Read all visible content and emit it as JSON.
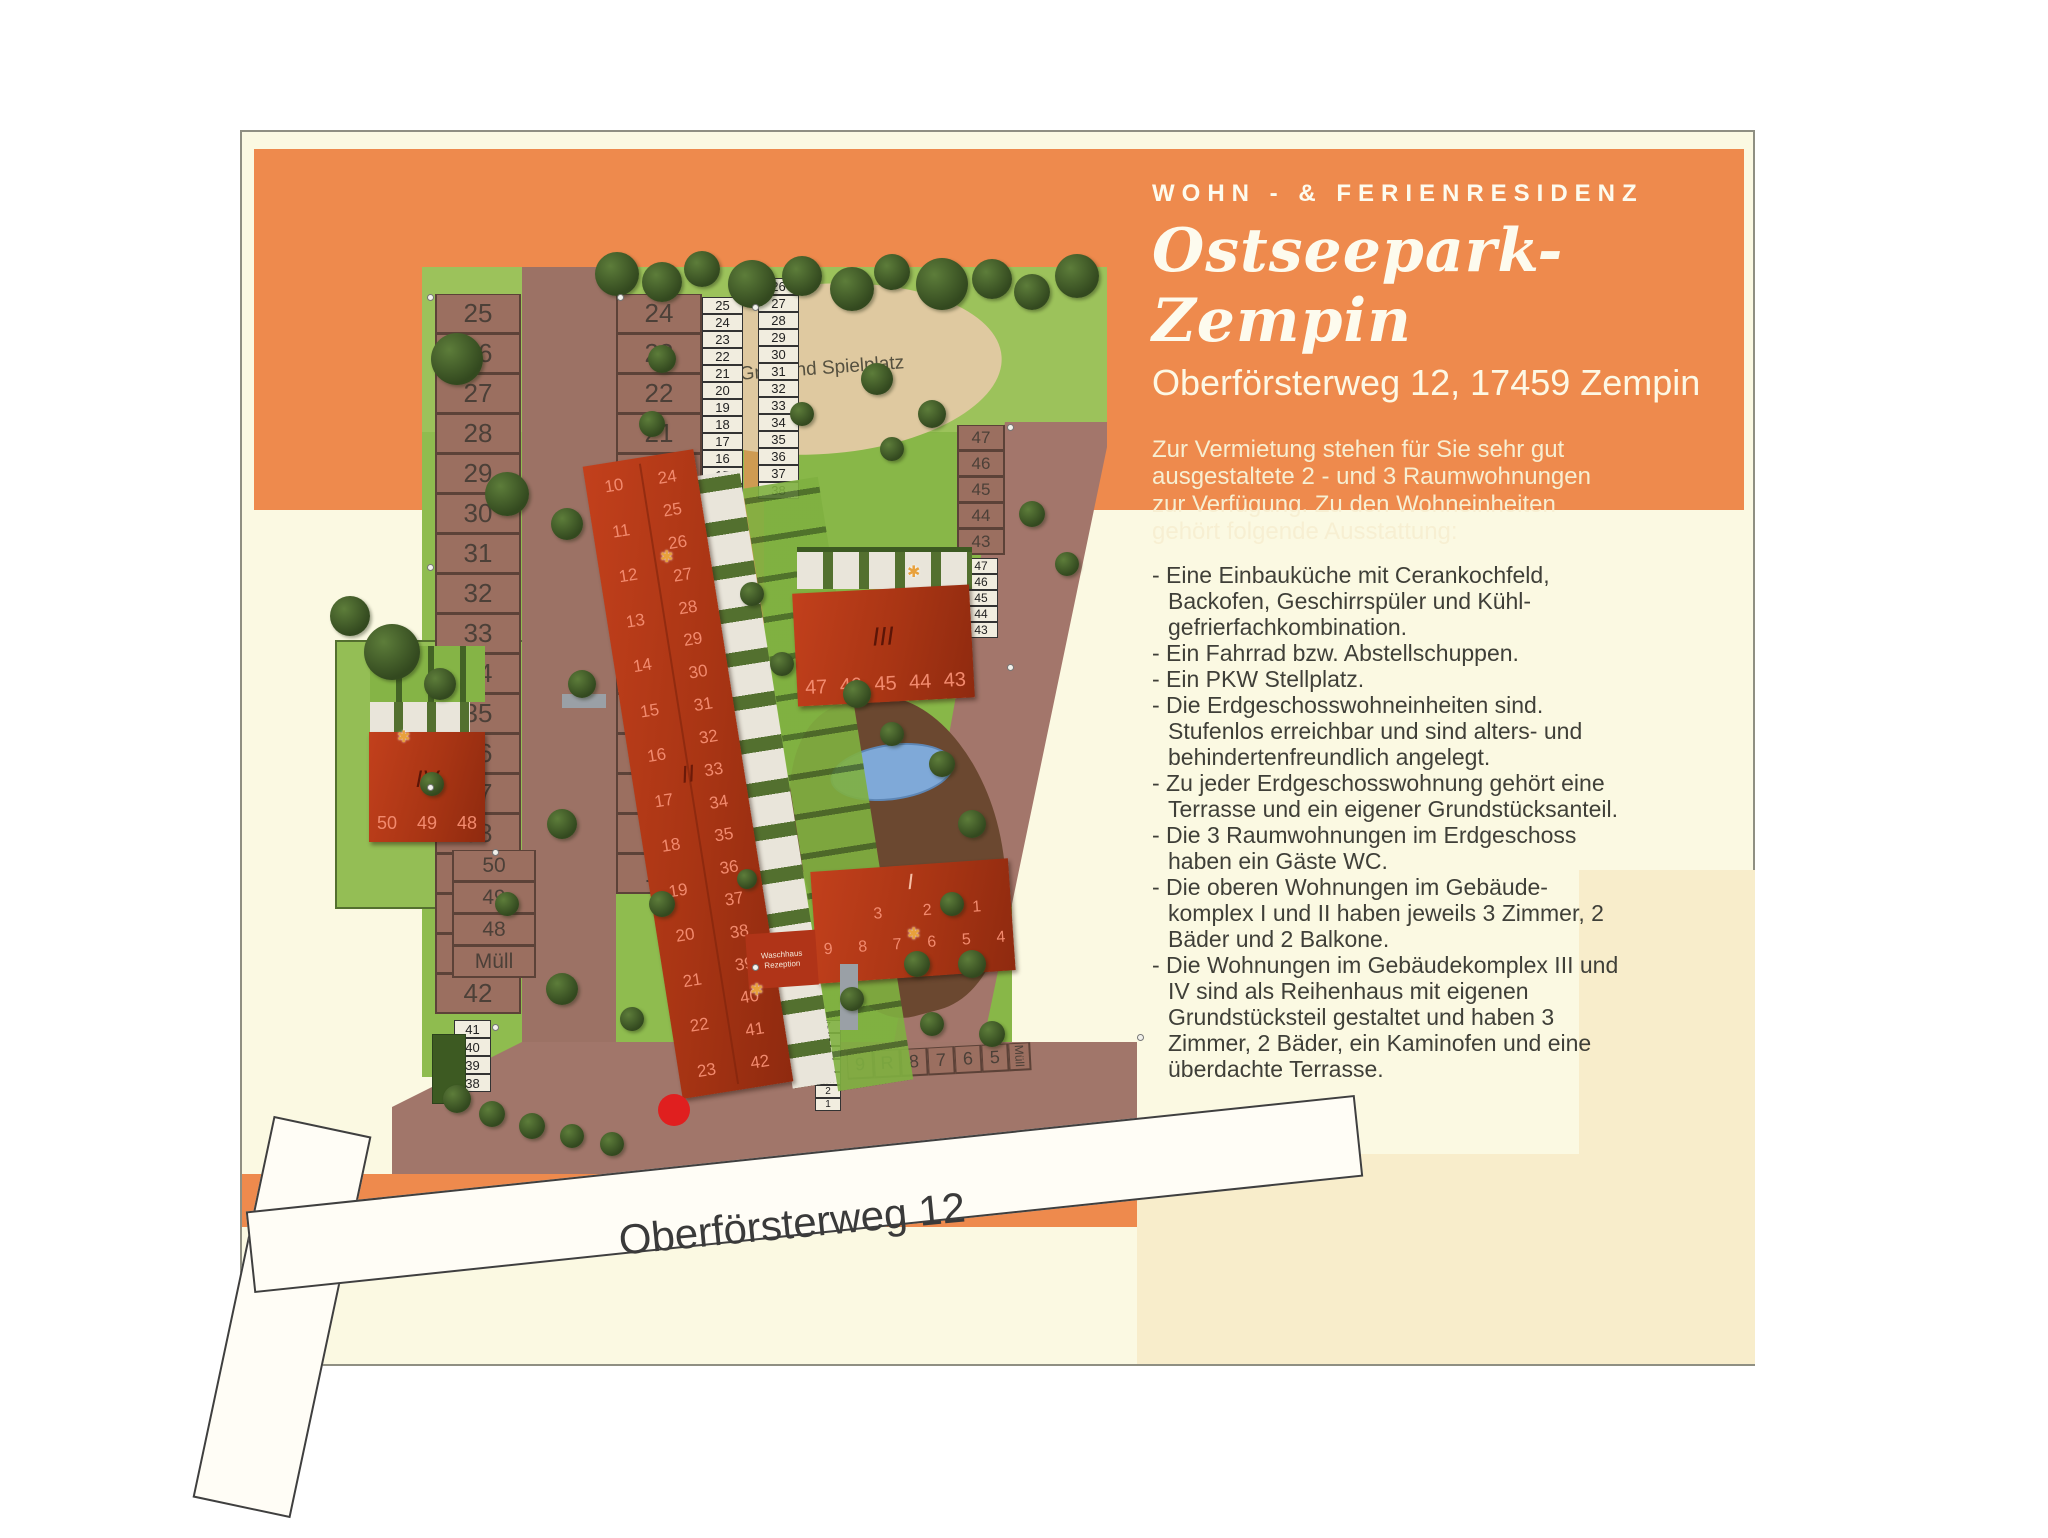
{
  "header": {
    "kicker": "WOHN - & FERIENRESIDENZ",
    "title": "Ostseepark-Zempin",
    "address": "Oberförsterweg 12, 17459 Zempin",
    "intro": "Zur Vermietung stehen für Sie sehr gut ausgestaltete 2 - und 3 Raumwohnungen zur Verfügung. Zu den Wohneinheiten gehört folgende Ausstattung:"
  },
  "features": [
    "- Eine Einbauküche mit Cerankochfeld, Backofen, Geschirrspüler und Kühl- gefrierfachkombination.",
    "- Ein Fahrrad bzw. Abstellschuppen.",
    "- Ein PKW Stellplatz.",
    "- Die Erdgeschosswohneinheiten sind. Stufenlos erreichbar und sind alters- und behindertenfreundlich angelegt.",
    "- Zu jeder Erdgeschosswohnung gehört eine Terrasse und ein eigener Grundstücksanteil.",
    "- Die 3 Raumwohnungen im Erdgeschoss haben ein Gäste WC.",
    "- Die oberen Wohnungen im Gebäude- komplex I und II haben jeweils 3 Zimmer, 2 Bäder und 2 Balkone.",
    "- Die Wohnungen im Gebäudekomplex III und IV sind als Reihenhaus mit eigenen Grundstücksteil gestaltet und haben 3 Zimmer, 2 Bäder, ein Kaminofen und eine überdachte Terrasse."
  ],
  "map_labels": {
    "grill": "Grill- und Spielplatz",
    "street": "Oberförsterweg 12",
    "muell": "Müll",
    "reserved": "R",
    "waschhaus1": "Waschhaus",
    "waschhaus2": "Rezeption"
  },
  "buildings": {
    "b1": {
      "label": "I",
      "row1": [
        "3",
        "2",
        "1"
      ],
      "row2": [
        "9",
        "8",
        "7",
        "6",
        "5",
        "4"
      ]
    },
    "b2": {
      "label": "II",
      "left": [
        "10",
        "11",
        "12",
        "13",
        "14",
        "15",
        "16",
        "17",
        "18",
        "19",
        "20",
        "21",
        "22",
        "23"
      ],
      "right": [
        "24",
        "25",
        "26",
        "27",
        "28",
        "29",
        "30",
        "31",
        "32",
        "33",
        "34",
        "35",
        "36",
        "37",
        "38",
        "39",
        "40",
        "41",
        "42"
      ]
    },
    "b3": {
      "label": "III",
      "units": [
        "47",
        "46",
        "45",
        "44",
        "43"
      ]
    },
    "b4": {
      "label": "IV",
      "units": [
        "50",
        "49",
        "48"
      ]
    }
  },
  "parking": {
    "col_a": [
      "25",
      "26",
      "27",
      "28",
      "29",
      "30",
      "31",
      "32",
      "33",
      "34",
      "35",
      "36",
      "37",
      "38",
      "39",
      "40",
      "41",
      "42"
    ],
    "col_b": [
      "24",
      "23",
      "22",
      "21",
      "20",
      "19",
      "18",
      "17",
      "16",
      "15",
      "14",
      "13",
      "12",
      "11",
      "10"
    ],
    "strip1": [
      "25",
      "24",
      "23",
      "22",
      "21",
      "20",
      "19",
      "18",
      "17",
      "16",
      "15",
      "14",
      "13",
      "12",
      "11",
      "10",
      "50",
      "49",
      "48"
    ],
    "strip2": [
      "26",
      "27",
      "28",
      "29",
      "30",
      "31",
      "32",
      "33",
      "34",
      "35",
      "36",
      "37",
      "38"
    ],
    "col_right": [
      "47",
      "46",
      "45",
      "44",
      "43"
    ],
    "strip3": [
      "47",
      "46",
      "45",
      "44",
      "43"
    ],
    "col_iv": [
      "50",
      "49",
      "48",
      "Müll"
    ],
    "strip4": [
      "41",
      "40",
      "39",
      "38"
    ],
    "stack_left": [
      "9",
      "8"
    ],
    "stack_right": [
      "7",
      "6",
      "5",
      "4",
      "3",
      "2",
      "1"
    ],
    "bottom_row": [
      "9",
      "R",
      "8",
      "7",
      "6",
      "5"
    ]
  },
  "colors": {
    "brand_orange": "#ee8a4d",
    "panel_cream": "#fbf9e2",
    "beige_block": "#f8edcb",
    "roof_red": "#c2401c",
    "grass_green": "#8fbc4f",
    "road_brown": "#9c7265",
    "sand": "#dfc9a0",
    "pond_blue": "#7fa9d8",
    "marker_red": "#e01f1f"
  }
}
